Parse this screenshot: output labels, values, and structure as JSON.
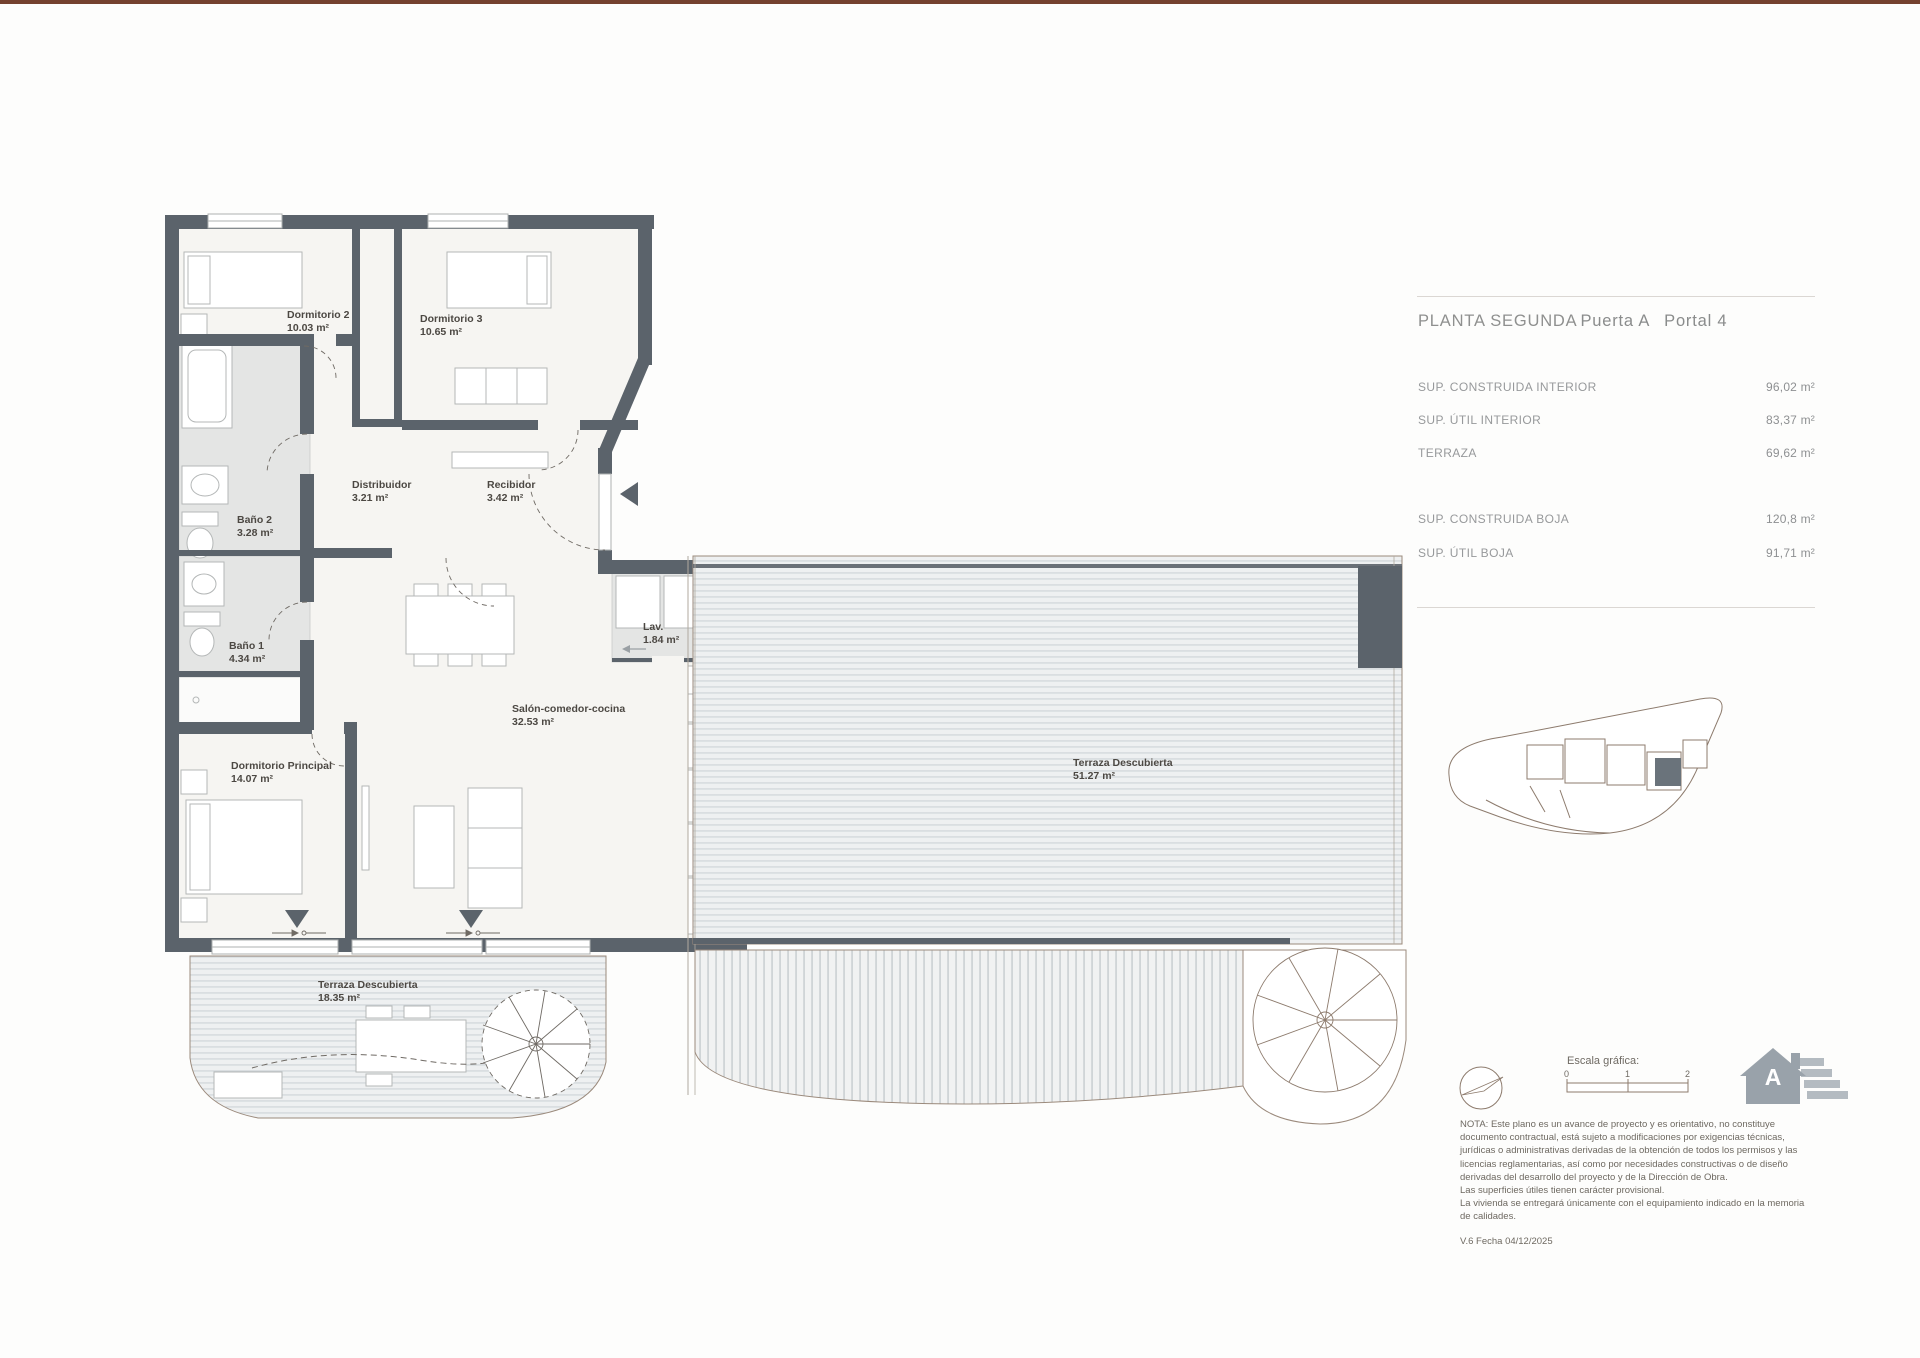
{
  "document": {
    "sheet_title_main": "PLANTA SEGUNDA",
    "sheet_title_unit": "Puerta A",
    "sheet_title_portal": "Portal 4",
    "version_line": "V.6 Fecha 04/12/2025"
  },
  "areas_table": {
    "rows": [
      {
        "label": "SUP. CONSTRUIDA INTERIOR",
        "value": "96,02 m²"
      },
      {
        "label": "SUP. ÚTIL INTERIOR",
        "value": "83,37 m²"
      },
      {
        "label": "TERRAZA",
        "value": "69,62 m²"
      }
    ],
    "rows_boja": [
      {
        "label": "SUP. CONSTRUIDA BOJA",
        "value": "120,8 m²"
      },
      {
        "label": "SUP. ÚTIL BOJA",
        "value": "91,71 m²"
      }
    ]
  },
  "plan": {
    "rooms": {
      "dormitorio2": {
        "name": "Dormitorio 2",
        "area": "10.03 m²"
      },
      "dormitorio3": {
        "name": "Dormitorio 3",
        "area": "10.65 m²"
      },
      "distribuidor": {
        "name": "Distribuidor",
        "area": "3.21 m²"
      },
      "recibidor": {
        "name": "Recibidor",
        "area": "3.42 m²"
      },
      "bano2": {
        "name": "Baño 2",
        "area": "3.28 m²"
      },
      "bano1": {
        "name": "Baño 1",
        "area": "4.34 m²"
      },
      "dormPrincipal": {
        "name": "Dormitorio Principal",
        "area": "14.07 m²"
      },
      "salon": {
        "name": "Salón-comedor-cocina",
        "area": "32.53 m²"
      },
      "lav": {
        "name": "Lav.",
        "area": "1.84 m²"
      },
      "terraza18": {
        "name": "Terraza Descubierta",
        "area": "18.35 m²"
      },
      "terraza51": {
        "name": "Terraza Descubierta",
        "area": "51.27 m²"
      }
    }
  },
  "scale_bar": {
    "label": "Escala gráfica:",
    "ticks": [
      "0",
      "1",
      "2"
    ]
  },
  "energy_icon": {
    "letter": "A"
  },
  "note": {
    "text": "NOTA: Este plano es un avance de proyecto y es orientativo, no constituye\ndocumento contractual, está sujeto a modificaciones por exigencias técnicas,\njurídicas o administrativas derivadas de la obtención de todos los permisos y las\nlicencias reglamentarias, así como por necesidades constructivas o de diseño\nderivadas del desarrollo del proyecto y de la Dirección de Obra.\nLas superficies útiles tienen carácter provisional.\nLa vivienda se entregará únicamente con el equipamiento indicado en la memoria\nde calidades."
  },
  "colors": {
    "wall": "#5b636b",
    "bath_fill": "#e4e5e4",
    "deck_line": "#ccd3d7",
    "accent_top_bar": "#74412f",
    "plan_stroke_brown": "#9b8a7c"
  }
}
